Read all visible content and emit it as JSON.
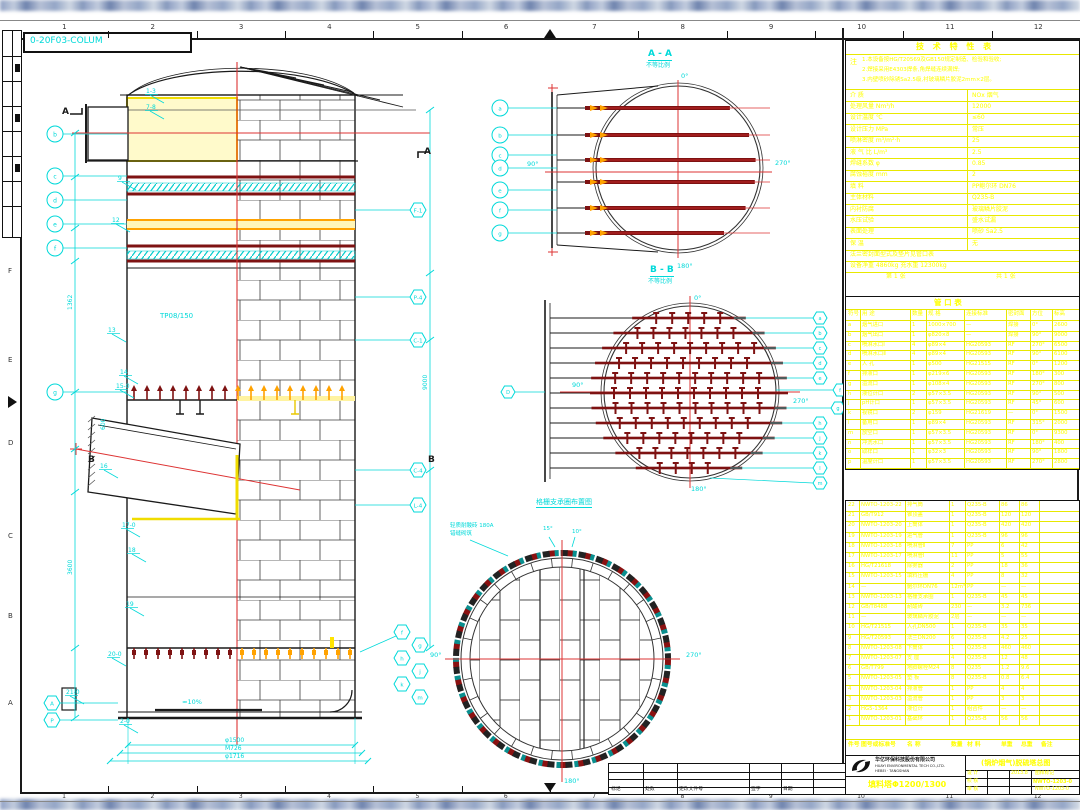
{
  "frame": {
    "drawing_no": "0-20F03-COLUM",
    "columns": [
      "1",
      "2",
      "3",
      "4",
      "5",
      "6",
      "7",
      "8",
      "9",
      "10",
      "11",
      "12"
    ],
    "rows": [
      "F",
      "E",
      "D",
      "C",
      "B",
      "A"
    ]
  },
  "elevation": {
    "mid_label": "TP08/150",
    "section_a": "A",
    "section_b": "B",
    "flags": [
      "1-3",
      "7-8",
      "9",
      "12",
      "13",
      "14",
      "15-0",
      "16",
      "17-0",
      "18",
      "19",
      "20-0",
      "21-0",
      "2-0"
    ],
    "left_balloons": [
      "b",
      "c",
      "d",
      "e",
      "f",
      "g"
    ],
    "left_balloons2": [
      "A",
      "P"
    ],
    "right_balloons": [
      "F-1",
      "P-4",
      "C-1",
      "C-4",
      "L-4"
    ],
    "cluster_balloons": [
      "f",
      "g",
      "h",
      "j",
      "k",
      "m"
    ],
    "dims_left": [
      "1362",
      "3600",
      "600"
    ],
    "dims_right": [
      "9000"
    ],
    "dims_bottom": [
      "φ1500",
      "M726",
      "φ1716"
    ],
    "slope_note": "≈10%"
  },
  "section_aa": {
    "title": "A - A",
    "subtitle": "不等比例",
    "angle_top": "0°",
    "angle_right": "270°",
    "angle_left": "90°",
    "angle_bottom": "180°",
    "balloons": [
      "a",
      "b",
      "c",
      "d",
      "e",
      "f",
      "g"
    ]
  },
  "section_bb": {
    "title": "B - B",
    "subtitle": "不等比例",
    "angle_top": "0°",
    "angle_right": "270°",
    "angle_left": "90°",
    "angle_bottom": "180°",
    "balloon_left": "D",
    "balloons_right": [
      "a",
      "b",
      "c",
      "d",
      "e",
      "f",
      "g",
      "h",
      "j",
      "k",
      "l",
      "m"
    ]
  },
  "plan": {
    "title": "格栅支承圈布置图",
    "note_line1": "轻质耐酸砖 180A",
    "note_line2": "错缝砌筑",
    "angle_left": "90°",
    "angle_right": "270°",
    "angle_bottom": "180°",
    "angle_t1": "15°",
    "angle_t2": "10°"
  },
  "tech_table": {
    "title": "技 术 特 性 表",
    "note_label": "注",
    "note_lines": [
      "1.本设备按HG/T20569及GB150规定制造、检验和验收;",
      "2.焊接采用E4303焊条,角焊缝连续满焊;",
      "3.内壁喷砂除锈Sa2.5级,衬玻璃鳞片胶泥2mm×2层。"
    ],
    "rows": [
      [
        "介 质",
        "NOx 烟气"
      ],
      [
        "处理风量 Nm³/h",
        "12000"
      ],
      [
        "设计温度 ℃",
        "≤60"
      ],
      [
        "设计压力 MPa",
        "常压"
      ],
      [
        "喷淋密度 m³/m²·h",
        "25"
      ],
      [
        "液 气 比 L/m³",
        "2.5"
      ],
      [
        "焊缝系数 φ",
        "0.85"
      ],
      [
        "腐蚀裕度 mm",
        "2"
      ],
      [
        "填 料",
        "PP鲍尔环 DN76"
      ],
      [
        "主体材料",
        "Q235-B"
      ],
      [
        "内衬防腐",
        "玻璃鳞片胶泥"
      ],
      [
        "水压试验",
        "盛水试漏"
      ],
      [
        "表面处理",
        "喷砂 Sa2.5"
      ],
      [
        "保 温",
        "无"
      ]
    ],
    "rows_wide": [
      "法兰密封面型式及垫片见管口表",
      "设备净重 4860kg   充水重 12300kg"
    ],
    "footer_left": "第 1 张",
    "footer_right": "共 1 张"
  },
  "nozzle_table": {
    "title": "管  口  表",
    "headers": [
      "符号",
      "用 途",
      "数量",
      "规 格",
      "连接标准",
      "密封面",
      "方位",
      "标高"
    ],
    "rows": [
      [
        "a",
        "烟气进口",
        "1",
        "1000×700",
        "—",
        "焊接",
        "0°",
        "2600"
      ],
      [
        "b",
        "烟气出口",
        "1",
        "φ820×8",
        "—",
        "焊接",
        "90°",
        "9000"
      ],
      [
        "c",
        "喷淋水口Ⅰ",
        "4",
        "φ89×4",
        "HG20593",
        "RF",
        "270°",
        "6500"
      ],
      [
        "d",
        "喷淋水口Ⅱ",
        "4",
        "φ89×4",
        "HG20593",
        "RF",
        "90°",
        "6100"
      ],
      [
        "e",
        "人 孔",
        "1",
        "φ500",
        "HG21515",
        "RF",
        "0°",
        "1200"
      ],
      [
        "f",
        "排液口",
        "1",
        "φ219×6",
        "HG20593",
        "RF",
        "180°",
        "300"
      ],
      [
        "g",
        "溢流口",
        "1",
        "φ108×4",
        "HG20593",
        "RF",
        "270°",
        "800"
      ],
      [
        "h",
        "液位计口",
        "2",
        "φ57×3.5",
        "HG20593",
        "RF",
        "90°",
        "500"
      ],
      [
        "j",
        "pH计口",
        "1",
        "φ57×3.5",
        "HG20593",
        "RF",
        "45°",
        "600"
      ],
      [
        "k",
        "视镜口",
        "2",
        "φ159",
        "HG21619",
        "—",
        "0°",
        "1500"
      ],
      [
        "l",
        "备用口",
        "1",
        "φ89×4",
        "HG20593",
        "RF",
        "315°",
        "2000"
      ],
      [
        "m",
        "放空口",
        "1",
        "φ57×3.5",
        "HG20593",
        "RF",
        "0°",
        "9300"
      ],
      [
        "n",
        "冲洗水口",
        "1",
        "φ57×3.5",
        "HG20593",
        "RF",
        "180°",
        "400"
      ],
      [
        "o",
        "取样口",
        "1",
        "φ32×3",
        "HG20593",
        "RF",
        "90°",
        "1800"
      ],
      [
        "p",
        "温度计口",
        "1",
        "φ57×3.5",
        "HG20593",
        "RF",
        "270°",
        "2800"
      ]
    ]
  },
  "bom": {
    "headers": [
      "件号",
      "图号或标准号",
      "名 称",
      "数量",
      "材 料",
      "单重",
      "总重",
      "备注"
    ],
    "rows": [
      [
        "22",
        "NWTO-1203-22",
        "排气筒",
        "1",
        "Q235-B",
        "86",
        "86",
        ""
      ],
      [
        "21",
        "GB/T912",
        "锥顶盖",
        "1",
        "Q235-B",
        "120",
        "120",
        ""
      ],
      [
        "20",
        "NWTO-1203-20",
        "上筒体",
        "1",
        "Q235-B",
        "420",
        "420",
        ""
      ],
      [
        "19",
        "NWTO-1203-19",
        "进气管",
        "1",
        "Q235-B",
        "96",
        "96",
        ""
      ],
      [
        "18",
        "NWTO-1203-18",
        "喷淋管Ⅱ",
        "7",
        "PP",
        "6",
        "42",
        ""
      ],
      [
        "17",
        "NWTO-1203-17",
        "喷淋管Ⅰ",
        "11",
        "PP",
        "5",
        "55",
        ""
      ],
      [
        "16",
        "HG/T21618",
        "除雾器",
        "2",
        "PP",
        "18",
        "36",
        ""
      ],
      [
        "15",
        "NWTO-1203-15",
        "填料压栅",
        "4",
        "PP",
        "8",
        "32",
        ""
      ],
      [
        "14",
        "—",
        "鲍尔环DN76",
        "12m³",
        "PP",
        "—",
        "—",
        ""
      ],
      [
        "13",
        "NWTO-1203-13",
        "格栅支承圈",
        "1",
        "Q235-B",
        "45",
        "45",
        ""
      ],
      [
        "12",
        "GB/T8488",
        "耐酸砖",
        "230",
        "—",
        "3.2",
        "736",
        ""
      ],
      [
        "11",
        "—",
        "玻璃鳞片胶泥",
        "2层",
        "—",
        "—",
        "—",
        ""
      ],
      [
        "10",
        "HG/T21515",
        "人孔DN500",
        "1",
        "Q235-B",
        "35",
        "35",
        ""
      ],
      [
        "9",
        "HG/T20593",
        "法兰DN200",
        "6",
        "Q235-B",
        "4.2",
        "25",
        ""
      ],
      [
        "8",
        "NWTO-1203-08",
        "下筒体",
        "1",
        "Q235-B",
        "460",
        "460",
        ""
      ],
      [
        "7",
        "NWTO-1203-07",
        "支 座",
        "4",
        "Q235-B",
        "12",
        "48",
        ""
      ],
      [
        "6",
        "GB/T799",
        "地脚螺栓M24",
        "8",
        "Q235",
        "1.2",
        "9.6",
        ""
      ],
      [
        "5",
        "NWTO-1203-05",
        "垫 板",
        "8",
        "Q235-B",
        "0.8",
        "6.4",
        ""
      ],
      [
        "4",
        "NWTO-1203-04",
        "排液管",
        "1",
        "PP",
        "4",
        "4",
        ""
      ],
      [
        "3",
        "NWTO-1203-03",
        "溢流管",
        "1",
        "PP",
        "3",
        "3",
        ""
      ],
      [
        "2",
        "HG5-1364",
        "液位计",
        "1",
        "组合件",
        "—",
        "—",
        ""
      ],
      [
        "1",
        "NWTO-1203-01",
        "基础环",
        "1",
        "Q235-B",
        "56",
        "56",
        ""
      ]
    ]
  },
  "revision": {
    "cells": [
      "标记",
      "处数",
      "更改文件号",
      "签字",
      "日期",
      ""
    ]
  },
  "title_block": {
    "company_cn": "华亿环保科技股份有限公司",
    "company_en": "HUAYI ENVIRONMENTAL TECH CO.,LTD.",
    "company_sub": "HEBEI · TANGSHAN",
    "product": "填料塔Φ1200/1300",
    "main_title": "(锅炉烟气)脱硫塔总图",
    "doc_no": "NWTO-1203-0",
    "grid": [
      [
        "设 计",
        "",
        "2013.8",
        "图样标记",
        "质量",
        "比例"
      ],
      [
        "校 核",
        "",
        "",
        "",
        "",
        "1:25"
      ],
      [
        "审 核",
        "",
        "",
        "NWTO-1203-0",
        "",
        ""
      ]
    ]
  }
}
